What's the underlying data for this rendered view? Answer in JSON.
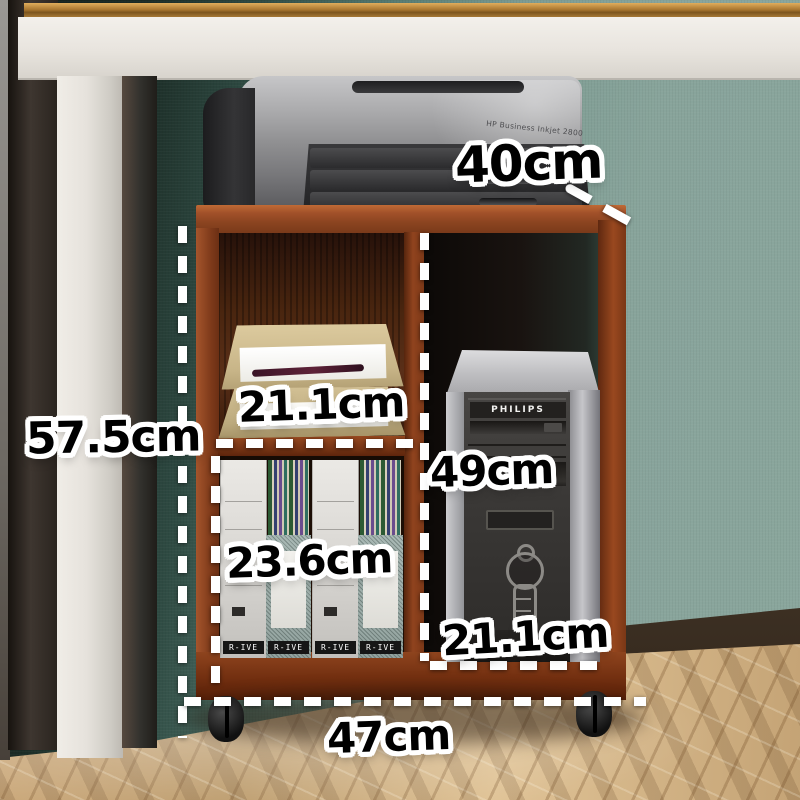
{
  "measurements": {
    "printer_shelf_depth": "40cm",
    "overall_height": "57.5cm",
    "upper_shelf_width": "21.1cm",
    "tower_compartment_height": "49cm",
    "file_compartment_height": "23.6cm",
    "tower_compartment_width": "21.1cm",
    "overall_width": "47cm"
  },
  "printer": {
    "model_text": "HP Business Inkjet 2800"
  },
  "computer": {
    "brand_text": "PHILIPS"
  },
  "file_boxes": {
    "labels": [
      "R-IVE",
      "R-IVE",
      "R-IVE",
      "R-IVE"
    ]
  },
  "colors": {
    "cabinet_wood": "#8a421f",
    "wall_teal": "#88a49b",
    "wall_shadow": "#1b2b25",
    "floor_wood": "#c4a375",
    "dimension_text": "#000000",
    "dimension_outline": "#ffffff",
    "measure_line": "#ffffff"
  }
}
